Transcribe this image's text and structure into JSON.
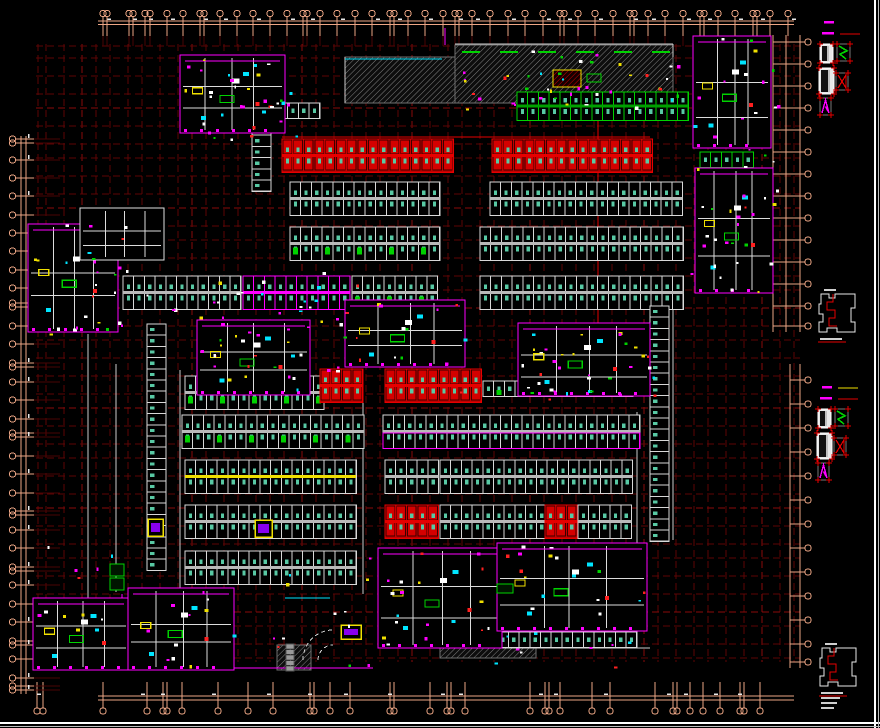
{
  "meta": {
    "width": 880,
    "height": 728,
    "background": "#000000",
    "drawing_type": "underground-parking-garage-floor-plan"
  },
  "palette": {
    "grid": "#5e0505",
    "grid_bright": "#8a0a0a",
    "dim": "#eda685",
    "white": "#e0e0e0",
    "gray": "#b9b9b9",
    "red": "#e60000",
    "red_dark": "#b30000",
    "magenta": "#ff00ff",
    "cyan": "#00e5ff",
    "yellow": "#f0e000",
    "green": "#00d200",
    "marker": "#58c9a4",
    "hatch_line": "#8f8f8f",
    "purple": "#8800ee",
    "frame": "#ffffff"
  },
  "frame": {
    "right_x": 875,
    "bottom_y": 723
  },
  "dims": {
    "top": {
      "y_line1": 21,
      "y_line2": 24.5,
      "x1": 98,
      "x2": 794,
      "bubble_y": 13.5,
      "tick_to": 36,
      "bubbles": [
        103,
        107,
        129,
        133,
        145,
        150,
        167,
        183,
        200,
        204,
        220,
        237,
        253,
        270,
        287,
        303,
        307,
        320,
        337,
        355,
        372,
        390,
        394,
        408,
        425,
        443,
        455,
        459,
        472,
        490,
        508,
        525,
        543,
        560,
        564,
        578,
        595,
        613,
        630,
        634,
        648,
        665,
        683,
        700,
        704,
        718,
        735,
        753,
        757,
        770,
        788
      ]
    },
    "bottom": {
      "y_line1": 696,
      "y_line2": 700,
      "x1": 98,
      "x2": 794,
      "bubble_y": 711,
      "tick_from": 682,
      "bubbles": [
        37,
        43,
        103,
        147,
        163,
        167,
        182,
        218,
        248,
        273,
        310,
        314,
        330,
        350,
        390,
        394,
        430,
        447,
        451,
        465,
        530,
        545,
        549,
        560,
        592,
        610,
        655,
        673,
        677,
        690,
        703,
        720,
        740,
        744,
        760
      ]
    },
    "left": {
      "x_line1": 21,
      "x_line2": 26,
      "y1": 136,
      "y2": 694,
      "bubble_x": 12.5,
      "tick_to": 34,
      "bubbles": [
        139,
        143,
        160,
        178,
        196,
        215,
        233,
        251,
        270,
        288,
        303,
        307,
        326,
        344,
        363,
        367,
        382,
        400,
        419,
        433,
        437,
        456,
        474,
        493,
        511,
        515,
        530,
        548,
        567,
        571,
        585,
        604,
        622,
        641,
        645,
        659,
        678,
        686,
        690
      ]
    },
    "right_upper": {
      "x_line1": 773,
      "x_line2": 786,
      "x_line3": 800,
      "y1": 35,
      "y2": 332,
      "bubble_x": 808,
      "bubbles": [
        42,
        64,
        86,
        108,
        130,
        152,
        174,
        196,
        218,
        240,
        262,
        284,
        306,
        326
      ]
    },
    "right_lower": {
      "x_line1": 790,
      "x_line2": 800,
      "y1": 364,
      "y2": 668,
      "bubble_x": 808,
      "bubbles": [
        380,
        404,
        428,
        452,
        476,
        500,
        524,
        548,
        572,
        596,
        620,
        644,
        662
      ]
    }
  },
  "grid": {
    "x_range": [
      36,
      800
    ],
    "y_range": [
      44,
      662
    ],
    "vxs": [
      38,
      46,
      64,
      82,
      96,
      110,
      128,
      142,
      160,
      178,
      192,
      206,
      224,
      238,
      256,
      270,
      284,
      302,
      316,
      334,
      352,
      366,
      380,
      398,
      412,
      430,
      448,
      462,
      480,
      494,
      512,
      530,
      544,
      562,
      576,
      594,
      612,
      626,
      644,
      658,
      676,
      694,
      708,
      726,
      744,
      762,
      780,
      794
    ],
    "hys": [
      46,
      58,
      76,
      94,
      108,
      126,
      144,
      158,
      176,
      194,
      208,
      226,
      240,
      258,
      276,
      290,
      308,
      326,
      340,
      358,
      376,
      394,
      408,
      426,
      444,
      458,
      476,
      494,
      508,
      526,
      544,
      558,
      576,
      594,
      612,
      626,
      644,
      658
    ]
  },
  "hatches": [
    {
      "x": 345,
      "y": 57,
      "w": 112,
      "h": 46
    },
    {
      "x": 455,
      "y": 45,
      "w": 218,
      "h": 58
    },
    {
      "x": 140,
      "y": 592,
      "w": 66,
      "h": 76
    },
    {
      "x": 440,
      "y": 608,
      "w": 96,
      "h": 50
    },
    {
      "x": 277,
      "y": 645,
      "w": 34,
      "h": 25
    }
  ],
  "rows": [
    {
      "x": 277,
      "y": 103,
      "n": 4,
      "rows": 1,
      "style": "white"
    },
    {
      "x": 517,
      "y": 92,
      "n": 16,
      "rows": 2,
      "style": "green",
      "sh": 13
    },
    {
      "x": 282,
      "y": 139,
      "n": 16,
      "rows": 2,
      "style": "red"
    },
    {
      "x": 492,
      "y": 139,
      "n": 15,
      "rows": 2,
      "style": "red"
    },
    {
      "x": 290,
      "y": 182,
      "n": 14,
      "rows": 2,
      "style": "white"
    },
    {
      "x": 490,
      "y": 182,
      "n": 18,
      "rows": 2,
      "style": "white"
    },
    {
      "x": 290,
      "y": 227,
      "n": 14,
      "rows": 2,
      "style": "white",
      "green": true
    },
    {
      "x": 480,
      "y": 227,
      "n": 19,
      "rows": 2,
      "style": "white"
    },
    {
      "x": 123,
      "y": 276,
      "n": 11,
      "rows": 2,
      "style": "white"
    },
    {
      "x": 243,
      "y": 276,
      "n": 10,
      "rows": 2,
      "style": "magenta"
    },
    {
      "x": 352,
      "y": 276,
      "n": 8,
      "rows": 2,
      "style": "white",
      "green": true
    },
    {
      "x": 480,
      "y": 276,
      "n": 19,
      "rows": 2,
      "style": "white"
    },
    {
      "x": 700,
      "y": 152,
      "n": 5,
      "rows": 1,
      "style": "green"
    },
    {
      "x": 700,
      "y": 222,
      "n": 5,
      "rows": 1,
      "style": "white"
    },
    {
      "x": 185,
      "y": 376,
      "n": 13,
      "rows": 2,
      "style": "white",
      "green": true
    },
    {
      "x": 320,
      "y": 369,
      "n": 4,
      "rows": 2,
      "style": "red"
    },
    {
      "x": 385,
      "y": 369,
      "n": 9,
      "rows": 2,
      "style": "red"
    },
    {
      "x": 483,
      "y": 381,
      "n": 14,
      "rows": 1,
      "style": "white",
      "green": true
    },
    {
      "x": 182,
      "y": 415,
      "n": 17,
      "rows": 2,
      "style": "white",
      "green": true
    },
    {
      "x": 383,
      "y": 415,
      "n": 24,
      "rows": 2,
      "style": "whitemag"
    },
    {
      "x": 185,
      "y": 460,
      "n": 16,
      "rows": 2,
      "style": "white",
      "band": "#f0e000"
    },
    {
      "x": 385,
      "y": 460,
      "n": 5,
      "rows": 2,
      "style": "white"
    },
    {
      "x": 440,
      "y": 460,
      "n": 18,
      "rows": 2,
      "style": "white"
    },
    {
      "x": 185,
      "y": 505,
      "n": 16,
      "rows": 2,
      "style": "white"
    },
    {
      "x": 385,
      "y": 505,
      "n": 5,
      "rows": 2,
      "style": "red"
    },
    {
      "x": 440,
      "y": 505,
      "n": 10,
      "rows": 2,
      "style": "white"
    },
    {
      "x": 545,
      "y": 505,
      "n": 3,
      "rows": 2,
      "style": "red"
    },
    {
      "x": 578,
      "y": 505,
      "n": 5,
      "rows": 2,
      "style": "white"
    },
    {
      "x": 185,
      "y": 551,
      "n": 16,
      "rows": 2,
      "style": "white"
    },
    {
      "x": 380,
      "y": 632,
      "n": 24,
      "rows": 1,
      "style": "white"
    }
  ],
  "vcols": [
    {
      "x": 252,
      "y": 124,
      "n": 6,
      "style": "white"
    },
    {
      "x": 147,
      "y": 324,
      "n": 22,
      "style": "white"
    },
    {
      "x": 650,
      "y": 306,
      "n": 21,
      "style": "white"
    }
  ],
  "buildings": [
    {
      "id": "b1",
      "x": 180,
      "y": 55,
      "w": 105,
      "h": 78
    },
    {
      "id": "b3",
      "x": 693,
      "y": 36,
      "w": 78,
      "h": 112
    },
    {
      "id": "b4",
      "x": 695,
      "y": 168,
      "w": 78,
      "h": 125
    },
    {
      "id": "b6",
      "x": 28,
      "y": 224,
      "w": 90,
      "h": 108
    },
    {
      "id": "b7",
      "x": 197,
      "y": 320,
      "w": 113,
      "h": 75
    },
    {
      "id": "b8",
      "x": 345,
      "y": 300,
      "w": 120,
      "h": 67
    },
    {
      "id": "b9",
      "x": 518,
      "y": 323,
      "w": 132,
      "h": 73
    },
    {
      "id": "b10",
      "x": 33,
      "y": 598,
      "w": 96,
      "h": 72
    },
    {
      "id": "b11",
      "x": 128,
      "y": 588,
      "w": 106,
      "h": 82
    },
    {
      "id": "b12",
      "x": 378,
      "y": 548,
      "w": 124,
      "h": 100
    },
    {
      "id": "b13",
      "x": 497,
      "y": 543,
      "w": 150,
      "h": 88
    },
    {
      "id": "corridor",
      "x": 80,
      "y": 208,
      "w": 84,
      "h": 52,
      "kind": "outline"
    }
  ],
  "walls": [
    {
      "c": "#cccccc",
      "p": [
        455,
        44,
        673,
        44
      ]
    },
    {
      "c": "#cccccc",
      "p": [
        673,
        44,
        673,
        57
      ]
    },
    {
      "c": "#cccccc",
      "p": [
        345,
        57,
        345,
        103
      ]
    },
    {
      "c": "#00e5ff",
      "p": [
        345,
        59,
        442,
        59
      ]
    },
    {
      "c": "#cccccc",
      "p": [
        88,
        334,
        88,
        598
      ]
    },
    {
      "c": "#cccccc",
      "p": [
        116,
        364,
        116,
        592
      ]
    },
    {
      "c": "#cccccc",
      "p": [
        180,
        370,
        180,
        594
      ]
    },
    {
      "c": "#cccccc",
      "p": [
        363,
        370,
        363,
        594
      ]
    },
    {
      "c": "#cccccc",
      "p": [
        637,
        412,
        637,
        633
      ]
    },
    {
      "c": "#cccccc",
      "p": [
        673,
        307,
        673,
        540
      ]
    },
    {
      "c": "#cccccc",
      "p": [
        128,
        598,
        180,
        598
      ]
    },
    {
      "c": "#cccccc",
      "p": [
        378,
        648,
        650,
        648
      ]
    },
    {
      "c": "#ff00ff",
      "p": [
        122,
        594,
        122,
        668
      ]
    },
    {
      "c": "#ff00ff",
      "p": [
        33,
        668,
        373,
        668
      ]
    },
    {
      "c": "#ff00ff",
      "p": [
        445,
        28,
        445,
        45
      ]
    },
    {
      "c": "#f0e000",
      "p": [
        183,
        60,
        183,
        125
      ]
    },
    {
      "c": "#f0e000",
      "p": [
        274,
        60,
        274,
        125
      ]
    },
    {
      "c": "#e60000",
      "p": [
        598,
        118,
        598,
        338
      ]
    },
    {
      "c": "#e60000",
      "p": [
        282,
        137,
        650,
        137
      ]
    },
    {
      "c": "#00e5ff",
      "p": [
        285,
        598,
        330,
        598
      ]
    }
  ],
  "green_dashes": {
    "y": 52,
    "xs": [
      462,
      500,
      538,
      576,
      614,
      652
    ]
  },
  "yellow_boxes": [
    {
      "x": 148,
      "y": 519,
      "w": 15,
      "h": 17
    },
    {
      "x": 255,
      "y": 520,
      "w": 17,
      "h": 17
    },
    {
      "x": 341,
      "y": 625,
      "w": 20,
      "h": 14
    }
  ],
  "green_boxes": [
    {
      "x": 110,
      "y": 564,
      "w": 14,
      "h": 12
    },
    {
      "x": 110,
      "y": 578,
      "w": 14,
      "h": 12
    },
    {
      "x": 497,
      "y": 584,
      "w": 16,
      "h": 9
    }
  ],
  "equipment": {
    "x": 553,
    "y": 70,
    "w": 28,
    "h": 17
  },
  "gray_stack": {
    "x": 286,
    "y": 644,
    "n": 5,
    "w": 8,
    "h": 4.6
  },
  "roads": [
    "M 303 660 A 30 30 0 0 1 333 630",
    "M 318 660 A 15 15 0 0 1 333 645"
  ],
  "speck_zones": [
    {
      "x": 182,
      "y": 57,
      "w": 115,
      "h": 85,
      "n": 30
    },
    {
      "x": 445,
      "y": 48,
      "w": 235,
      "h": 62,
      "n": 42
    },
    {
      "x": 690,
      "y": 32,
      "w": 88,
      "h": 265,
      "n": 36
    },
    {
      "x": 30,
      "y": 222,
      "w": 100,
      "h": 112,
      "n": 24
    },
    {
      "x": 196,
      "y": 300,
      "w": 270,
      "h": 98,
      "n": 40
    },
    {
      "x": 512,
      "y": 320,
      "w": 145,
      "h": 80,
      "n": 30
    },
    {
      "x": 32,
      "y": 545,
      "w": 620,
      "h": 122,
      "n": 62
    },
    {
      "x": 120,
      "y": 268,
      "w": 240,
      "h": 44,
      "n": 18
    }
  ],
  "speck_colors": [
    "#ff00ff",
    "#00e5ff",
    "#f0e000",
    "#ffffff",
    "#00d200",
    "#ff2020",
    "#ff00ff",
    "#ffffff"
  ],
  "side_panel": {
    "legend_groups": [
      {
        "x": 816,
        "y": 16,
        "yellow_line": false
      },
      {
        "x": 814,
        "y": 381,
        "yellow_line": true
      }
    ],
    "keyplans": [
      {
        "x": 814,
        "y": 292,
        "caption_lines": 1
      },
      {
        "x": 815,
        "y": 646,
        "caption_lines": 4
      }
    ]
  },
  "row_styles": {
    "white": {
      "frame": "#d8d8d8",
      "cell": "#000000",
      "band": "#b9b9b9"
    },
    "red": {
      "frame": "#e60000",
      "cell": "#d40000",
      "band": "#e60000"
    },
    "green": {
      "frame": "#00d200",
      "cell": "#001500",
      "band": "#00a000"
    },
    "magenta": {
      "frame": "#ff00ff",
      "cell": "#000000",
      "band": "#ff00ff"
    },
    "whitemag": {
      "frame": "#d8d8d8",
      "cell": "#000000",
      "band": "#b9b9b9",
      "frame2": "#ff00ff"
    }
  },
  "labels": {
    "title": ""
  }
}
